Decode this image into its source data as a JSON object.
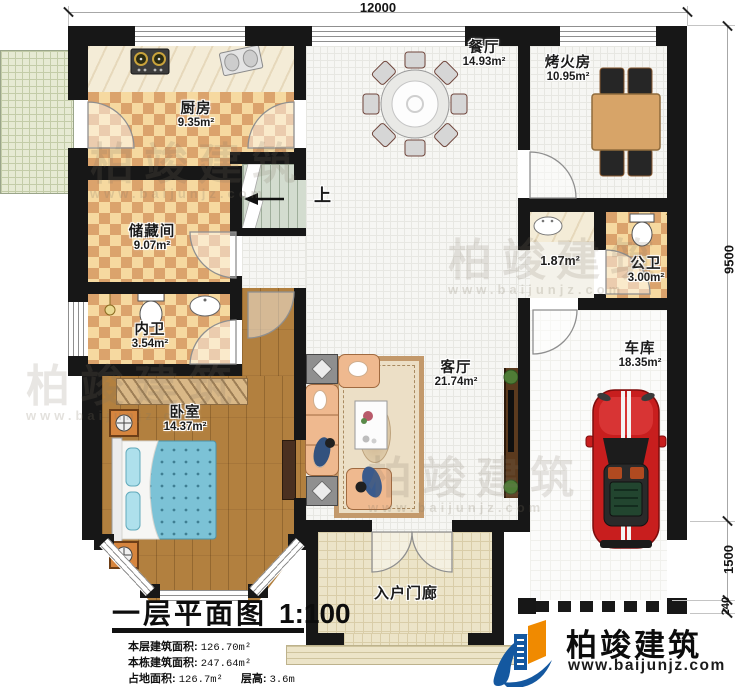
{
  "dimensions": {
    "top": "12000",
    "right_main": "9500",
    "right_porch": "1500",
    "right_wall": "240"
  },
  "rooms": {
    "kitchen": {
      "name": "厨房",
      "area": "9.35m²"
    },
    "storage": {
      "name": "储藏间",
      "area": "9.07m²"
    },
    "bath_private": {
      "name": "内卫",
      "area": "3.54m²"
    },
    "bedroom": {
      "name": "卧室",
      "area": "14.37m²"
    },
    "dining": {
      "name": "餐厅",
      "area": "14.93m²"
    },
    "fire_room": {
      "name": "烤火房",
      "area": "10.95m²"
    },
    "wash_area": {
      "area": "1.87m²"
    },
    "bath_public": {
      "name": "公卫",
      "area": "3.00m²"
    },
    "living": {
      "name": "客厅",
      "area": "21.74m²"
    },
    "garage": {
      "name": "车库",
      "area": "18.35m²"
    },
    "porch": {
      "name": "入户门廊"
    }
  },
  "stairs": {
    "up_label": "上"
  },
  "title_block": {
    "title": "一层平面图",
    "scale": "1:100",
    "line1_label": "本层建筑面积:",
    "line1_value": "126.70m²",
    "line2_label": "本栋建筑面积:",
    "line2_value": "247.64m²",
    "line3_label": "占地面积:",
    "line3_value": "126.7m²",
    "line4_label": "层高:",
    "line4_value": "3.6m"
  },
  "logo": {
    "name": "柏竣建筑",
    "url": "www.baijunjz.com"
  },
  "watermark": {
    "text": "柏竣建筑",
    "url": "www.baijunjz.com"
  }
}
